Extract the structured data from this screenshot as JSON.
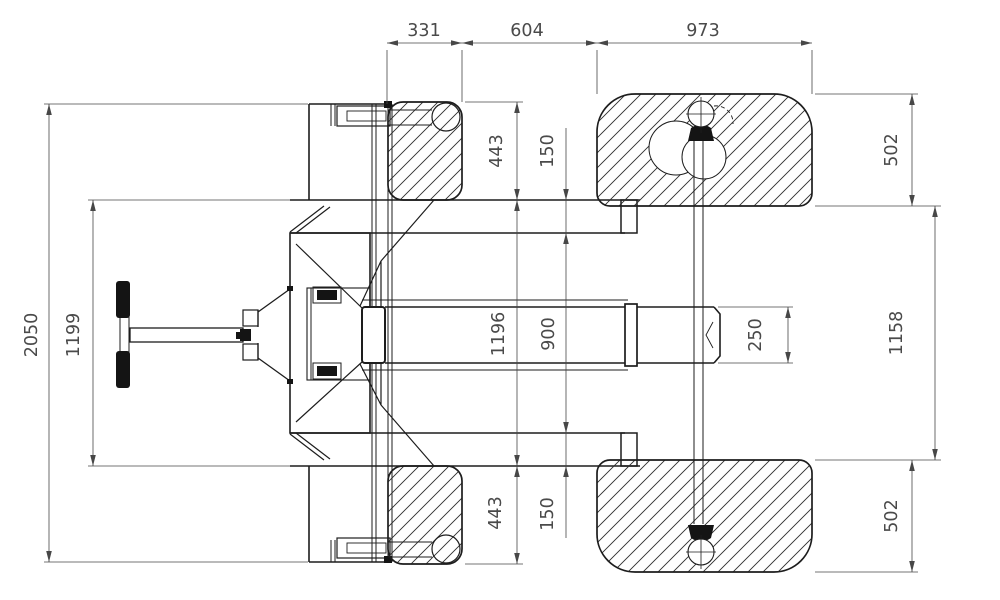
{
  "drawing": {
    "kind": "technical-dimension-drawing",
    "view": "plan",
    "colors": {
      "background": "#ffffff",
      "outline": "#1d1d1d",
      "hatch": "#2e2e2e",
      "dimension_lines": "#474747",
      "dimension_text": "#4a4a4a",
      "grip_fill": "#141414"
    }
  },
  "dimensions": [
    {
      "id": "width-331",
      "text": "331",
      "x": 424,
      "y": 36,
      "rot": 0
    },
    {
      "id": "width-604",
      "text": "604",
      "x": 527,
      "y": 36,
      "rot": 0
    },
    {
      "id": "width-973",
      "text": "973",
      "x": 703,
      "y": 36,
      "rot": 0
    },
    {
      "id": "length-2050",
      "text": "2050",
      "x": 37,
      "y": 335,
      "rot": -90
    },
    {
      "id": "length-1199",
      "text": "1199",
      "x": 79,
      "y": 335,
      "rot": -90
    },
    {
      "id": "height-443-top",
      "text": "443",
      "x": 502,
      "y": 151,
      "rot": -90
    },
    {
      "id": "gap-150-top",
      "text": "150",
      "x": 553,
      "y": 151,
      "rot": -90
    },
    {
      "id": "length-1196",
      "text": "1196",
      "x": 504,
      "y": 334,
      "rot": -90
    },
    {
      "id": "length-900",
      "text": "900",
      "x": 554,
      "y": 334,
      "rot": -90
    },
    {
      "id": "height-443-bottom",
      "text": "443",
      "x": 501,
      "y": 513,
      "rot": -90
    },
    {
      "id": "gap-150-bottom",
      "text": "150",
      "x": 553,
      "y": 514,
      "rot": -90
    },
    {
      "id": "fork-250",
      "text": "250",
      "x": 761,
      "y": 335,
      "rot": -90
    },
    {
      "id": "wheel-502-top",
      "text": "502",
      "x": 897,
      "y": 150,
      "rot": -90
    },
    {
      "id": "track-1158",
      "text": "1158",
      "x": 902,
      "y": 333,
      "rot": -90
    },
    {
      "id": "wheel-502-bottom",
      "text": "502",
      "x": 897,
      "y": 516,
      "rot": -90
    }
  ]
}
